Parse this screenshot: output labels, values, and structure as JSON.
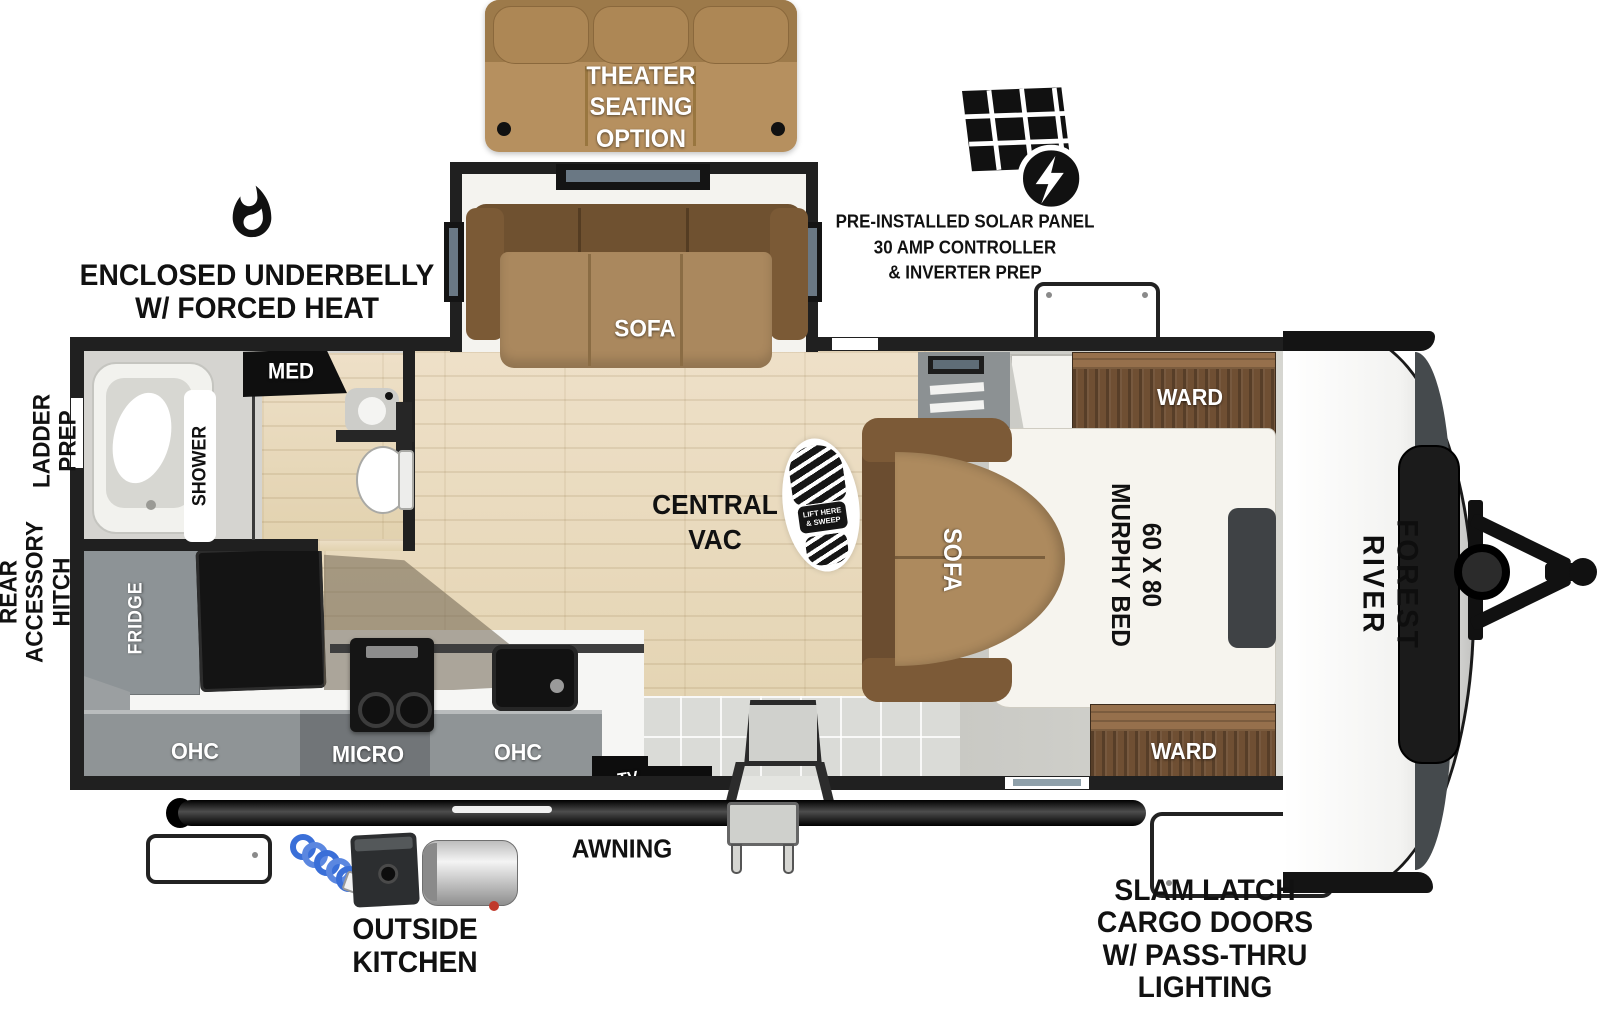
{
  "annotations": {
    "theater": "THEATER\nSEATING\nOPTION",
    "underbelly": "ENCLOSED UNDERBELLY\nW/ FORCED HEAT",
    "solar": "PRE-INSTALLED SOLAR PANEL\n30 AMP CONTROLLER\n& INVERTER PREP",
    "ladder_prep": "LADDER\nPREP",
    "rear_hitch": "REAR\nACCESSORY\nHITCH",
    "awning": "AWNING",
    "outside_kitchen": "OUTSIDE\nKITCHEN",
    "slam_latch": "SLAM LATCH\nCARGO DOORS\nW/ PASS-THRU\nLIGHTING"
  },
  "bathroom": {
    "med": "MED",
    "shower": "SHOWER"
  },
  "kitchen": {
    "fridge": "FRIDGE",
    "ohc_left": "OHC",
    "micro": "MICRO",
    "ohc_right": "OHC",
    "tv": "TV"
  },
  "living": {
    "central_vac": "CENTRAL\nVAC",
    "slide_sofa": "SOFA",
    "boot_note": "LIFT HERE\n& SWEEP"
  },
  "bedroom": {
    "sofa": "SOFA",
    "murphy_bed": "60 X 80\nMURPHY BED",
    "ward_front": "WARD",
    "ward_rear": "WARD"
  },
  "brand": {
    "name": "FOREST RIVER"
  },
  "colors": {
    "wall": "#202020",
    "wood_floor": "#e8dbbf",
    "sofa_tan": "#ad8a5e",
    "sofa_dark": "#6b4d30",
    "ward_wood": "#6f4f33",
    "cabinet_gray": "#8f9496",
    "hose_blue": "#3a6fd8"
  }
}
